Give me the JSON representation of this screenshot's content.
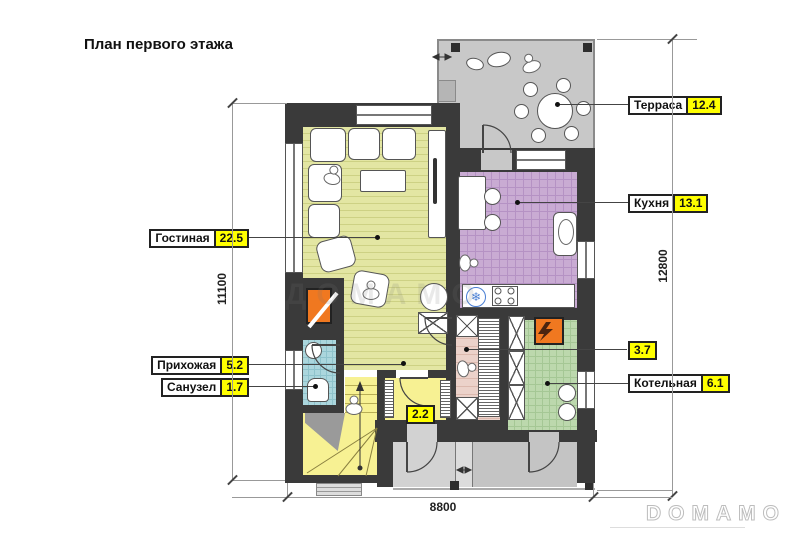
{
  "title": "План первого этажа",
  "labels": {
    "terrace": {
      "name": "Терраса",
      "area": "12.4"
    },
    "kitchen": {
      "name": "Кухня",
      "area": "13.1"
    },
    "living": {
      "name": "Гостиная",
      "area": "22.5"
    },
    "hallway": {
      "name": "Прихожая",
      "area": "5.2"
    },
    "bathroom": {
      "name": "Санузел",
      "area": "1.7"
    },
    "wardrobe": {
      "area": "3.7"
    },
    "boiler": {
      "name": "Котельная",
      "area": "6.1"
    },
    "vestibule": {
      "area": "2.2"
    }
  },
  "dimensions": {
    "bottom_width": "8800",
    "left_height": "11100",
    "right_height": "12800"
  },
  "watermarks": {
    "center": "ДОМАМО",
    "corner": "DOMAMO"
  },
  "icons": {
    "fridge": "❄"
  },
  "colors": {
    "wall": "#3a3a3a",
    "living_floor": "#e3e6a3",
    "stairs_floor": "#f7f193",
    "kitchen_floor": "#c9abd3",
    "bath_floor": "#abd6dd",
    "boiler_floor": "#bcd8ad",
    "wardrobe_floor": "#ecd2ca",
    "terrace_floor": "#c8c8c8",
    "label_highlight": "#ffff00",
    "fireplace": "#f07820"
  }
}
